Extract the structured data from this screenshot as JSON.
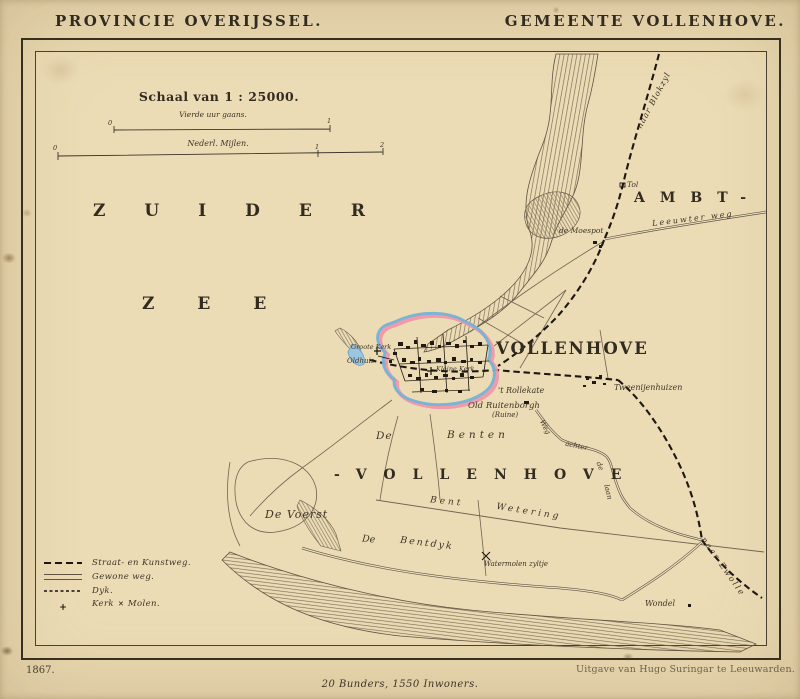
{
  "header": {
    "province": "PROVINCIE OVERIJSSEL.",
    "municipality": "GEMEENTE VOLLENHOVE."
  },
  "scale": {
    "heading": "Schaal van 1 : 25000.",
    "bar1": {
      "label": "Vierde uur gaans.",
      "t0": "0",
      "t1": "1"
    },
    "bar2": {
      "label": "Nederl. Mijlen.",
      "t0": "0",
      "t1": "1",
      "t2": "2"
    }
  },
  "sea": {
    "word1": "ZUIDER",
    "word2": "ZEE"
  },
  "regions": {
    "ambt": "AMBT-",
    "ambt_vollenhove": "-VOLLENHOVE",
    "benten_de": "De",
    "benten": "Benten",
    "de_voerst": "De Voerst"
  },
  "town": {
    "name": "VOLLENHOVE",
    "groote_kerk": "Groote Kerk",
    "oldhuis": "Oldhuis",
    "kleine_kerk": "Kleine Kerk",
    "rollekate": "'t Rollekate",
    "old_ruitenborgh": "Old Ruitenborgh",
    "ruine": "(Ruine)"
  },
  "places": {
    "tol": "Tol",
    "de_moespot": "de Moespot",
    "tweenijenhuizen": "Tweenijenhuizen",
    "watermolen": "Watermolen zyltje",
    "wondel": "Wondel"
  },
  "roads": {
    "naar_blokzyl": "naar Blokzyl",
    "leeuwter_weg": "Leeuwter weg",
    "weg": "Weg",
    "achter": "achter",
    "de": "de",
    "laan": "laan",
    "naar_zwolle": "naar Zwolle",
    "bent": "Bent",
    "wetering": "Wetering",
    "bentdyk_de": "De",
    "bentdyk": "Bentdyk"
  },
  "legend": {
    "straat": "Straat- en Kunstweg.",
    "gewone": "Gewone weg.",
    "dijk": "Dyk.",
    "kerk": "Kerk",
    "amp": "&",
    "molen": "Molen."
  },
  "icons": {
    "church_cross": "+",
    "windmill": "✕"
  },
  "footer": {
    "year": "1867.",
    "publisher": "Uitgave van Hugo Suringar te Leeuwarden.",
    "stats": "20 Bunders, 1550 Inwoners."
  },
  "colors": {
    "paper": "#e9d8b0",
    "ink": "#322b20",
    "boundary_pink": "#ef93a8",
    "water_blue": "#74b2d8"
  }
}
